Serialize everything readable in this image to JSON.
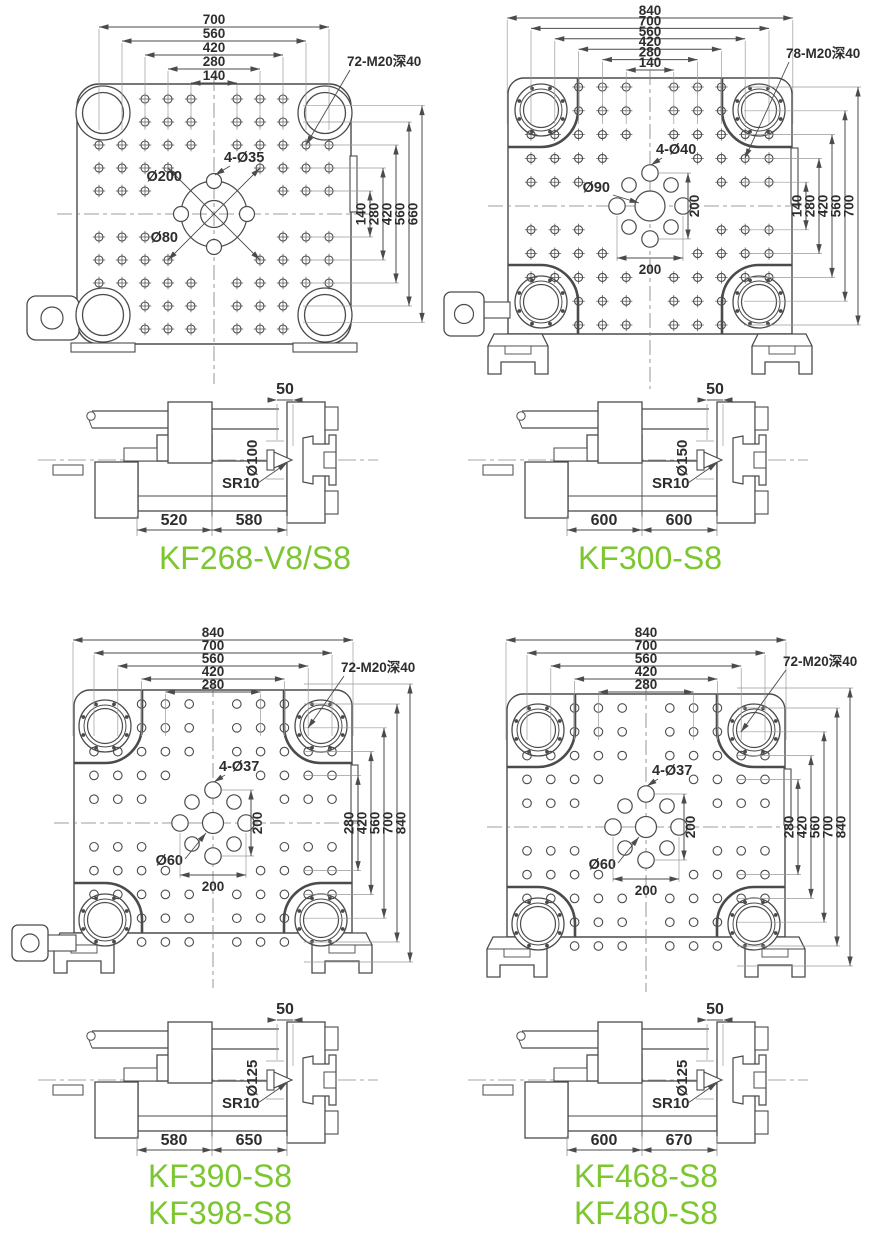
{
  "colors": {
    "drawing_line": "#4b4b4d",
    "dimension_text": "#2d2d2d",
    "model_label_green": "#7cc62f"
  },
  "drawings": [
    {
      "models": [
        "KF268-V8/S8"
      ],
      "plan_view": {
        "thread_note": "72-M20深40",
        "top_dims": [
          "700",
          "560",
          "420",
          "280",
          "140"
        ],
        "right_dims": [
          "140",
          "280",
          "420",
          "560",
          "660"
        ],
        "center_callouts": {
          "corner_holes": "4-Ø35",
          "bolt_circle": "Ø200",
          "center_hole": "Ø80"
        }
      },
      "side_view": {
        "nozzle_protrusion": "50",
        "locating_ring": "Ø100",
        "nozzle_radius": "SR10",
        "base_left": "520",
        "base_right": "580"
      }
    },
    {
      "models": [
        "KF300-S8"
      ],
      "plan_view": {
        "thread_note": "78-M20深40",
        "top_dims": [
          "840",
          "700",
          "560",
          "420",
          "280",
          "140"
        ],
        "right_dims": [
          "140",
          "280",
          "420",
          "560",
          "700"
        ],
        "center_callouts": {
          "corner_holes": "4-Ø40",
          "center_hole": "Ø90",
          "vertical_pitch": "200",
          "horizontal_pitch": "200"
        }
      },
      "side_view": {
        "nozzle_protrusion": "50",
        "locating_ring": "Ø150",
        "nozzle_radius": "SR10",
        "base_left": "600",
        "base_right": "600"
      }
    },
    {
      "models": [
        "KF390-S8",
        "KF398-S8"
      ],
      "plan_view": {
        "thread_note": "72-M20深40",
        "top_dims": [
          "840",
          "700",
          "560",
          "420",
          "280"
        ],
        "right_dims": [
          "280",
          "420",
          "560",
          "700",
          "840"
        ],
        "center_callouts": {
          "corner_holes": "4-Ø37",
          "center_hole": "Ø60",
          "vertical_pitch": "200",
          "horizontal_pitch": "200"
        }
      },
      "side_view": {
        "nozzle_protrusion": "50",
        "locating_ring": "Ø125",
        "nozzle_radius": "SR10",
        "base_left": "580",
        "base_right": "650"
      }
    },
    {
      "models": [
        "KF468-S8",
        "KF480-S8"
      ],
      "plan_view": {
        "thread_note": "72-M20深40",
        "top_dims": [
          "840",
          "700",
          "560",
          "420",
          "280"
        ],
        "right_dims": [
          "280",
          "420",
          "560",
          "700",
          "840"
        ],
        "center_callouts": {
          "corner_holes": "4-Ø37",
          "center_hole": "Ø60",
          "vertical_pitch": "200",
          "horizontal_pitch": "200"
        }
      },
      "side_view": {
        "nozzle_protrusion": "50",
        "locating_ring": "Ø125",
        "nozzle_radius": "SR10",
        "base_left": "600",
        "base_right": "670"
      }
    }
  ]
}
